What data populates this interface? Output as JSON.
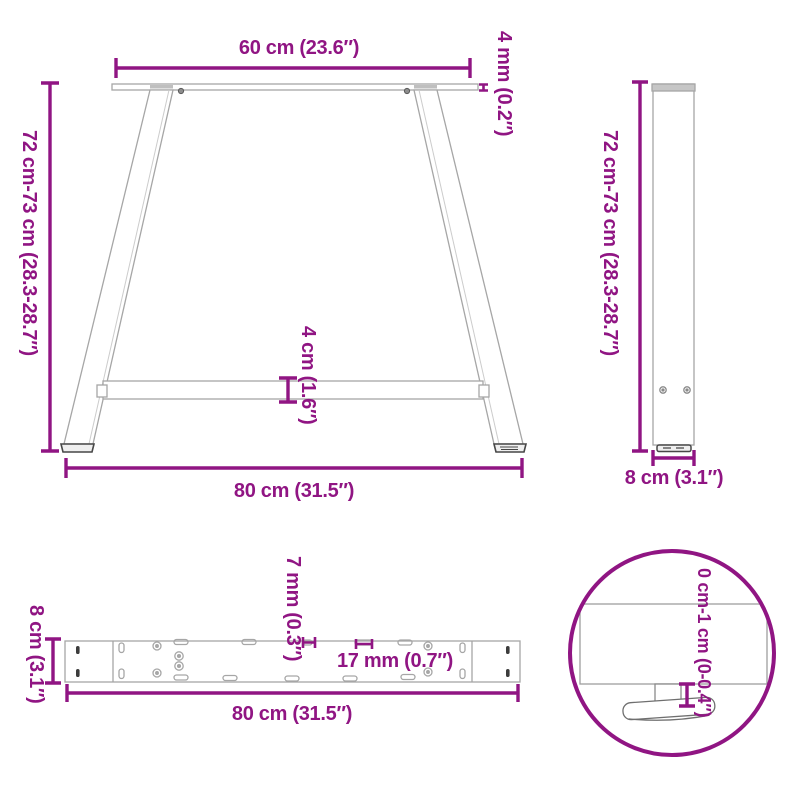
{
  "colors": {
    "accent": "#901583",
    "structure": "#a6a6a6"
  },
  "views": {
    "front": {
      "top_width": "60 cm (23.6″)",
      "plate_thickness": "4 mm (0.2″)",
      "height": "72 cm-73 cm (28.3-28.7″)",
      "crossbar_height": "4 cm (1.6″)",
      "bottom_width": "80 cm (31.5″)"
    },
    "side": {
      "height": "72 cm-73 cm (28.3-28.7″)",
      "depth": "8 cm (3.1″)"
    },
    "bar": {
      "depth": "8 cm (3.1″)",
      "slot_small": "7 mm (0.3″)",
      "slot_large": "17 mm (0.7″)",
      "length": "80 cm (31.5″)"
    },
    "detail": {
      "adjustable_range": "0 cm-1 cm (0-0.4″)"
    }
  }
}
